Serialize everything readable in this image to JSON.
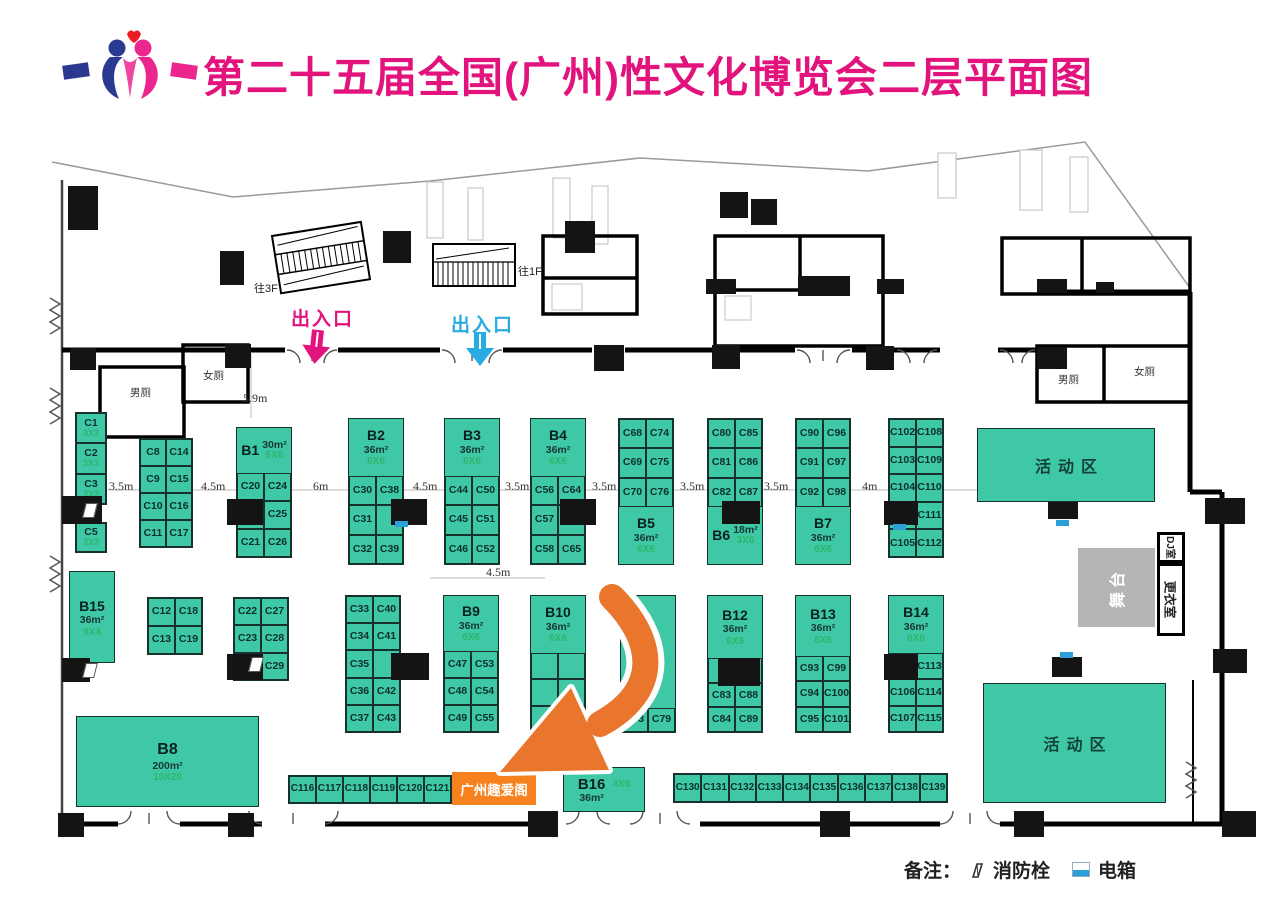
{
  "header": {
    "title": "第二十五届全国(广州)性文化博览会二层平面图",
    "logo_top": "全国(广州)性文化博览会",
    "logo_bottom": "China(Guangzhou)Sex Culture Expo"
  },
  "labels": {
    "entrance": "出入口",
    "stairs_3f": "往3F",
    "stairs_1f": "往1F",
    "toilet_male": "男厕",
    "toilet_female": "女厕",
    "stage": "舞台",
    "dj_room": "DJ室",
    "changing_room": "更衣室",
    "activity": "活动区",
    "qag": "广州趣爱阁"
  },
  "legend": {
    "note": "备注：",
    "hydrant": "消防栓",
    "power": "电箱"
  },
  "colors": {
    "booth_teal": "#3fc8a6",
    "dims_green": "#2fb56d",
    "accent_magenta": "#e2137d",
    "accent_blue": "#29abe2",
    "arrow_orange": "#e9762c",
    "qag_orange": "#f5821f",
    "stage_gray": "#b5b5b5"
  },
  "plan": {
    "dimensions": [
      {
        "t": "5.9m",
        "x": 243,
        "y": 391
      },
      {
        "t": "3.5m",
        "x": 109,
        "y": 479
      },
      {
        "t": "4.5m",
        "x": 201,
        "y": 479
      },
      {
        "t": "6m",
        "x": 313,
        "y": 479
      },
      {
        "t": "4.5m",
        "x": 413,
        "y": 479
      },
      {
        "t": "3.5m",
        "x": 505,
        "y": 479
      },
      {
        "t": "3.5m",
        "x": 592,
        "y": 479
      },
      {
        "t": "3.5m",
        "x": 680,
        "y": 479
      },
      {
        "t": "3.5m",
        "x": 764,
        "y": 479
      },
      {
        "t": "4m",
        "x": 862,
        "y": 479
      },
      {
        "t": "4.5m",
        "x": 486,
        "y": 565
      }
    ],
    "blocks": [
      {
        "name": "c1-col",
        "x": 75,
        "y": 412,
        "w": 32,
        "h": 93,
        "rows": [
          [
            "C1|3X3"
          ],
          [
            "C2|3X3"
          ],
          [
            "C3|3X3"
          ]
        ]
      },
      {
        "name": "c5",
        "x": 75,
        "y": 522,
        "w": 32,
        "h": 31,
        "rows": [
          [
            "C5|3X3"
          ]
        ]
      },
      {
        "name": "B15",
        "x": 69,
        "y": 571,
        "w": 46,
        "h": 92,
        "hdr": {
          "id": "B15",
          "area": "36m²",
          "dims": "9X4",
          "h": 92,
          "pos": "top"
        },
        "rows": []
      },
      {
        "name": "c8-blk",
        "x": 139,
        "y": 438,
        "w": 54,
        "h": 110,
        "rows": [
          [
            "C8",
            "C14"
          ],
          [
            "C9",
            "C15"
          ],
          [
            "C10",
            "C16"
          ],
          [
            "C11",
            "C17"
          ]
        ]
      },
      {
        "name": "B1",
        "x": 236,
        "y": 427,
        "w": 56,
        "h": 131,
        "hdr": {
          "id": "B1",
          "area": "30m²",
          "dims": "5X6",
          "h": 45,
          "pos": "top",
          "style": "side"
        },
        "rows": [
          [
            "C20",
            "C24"
          ],
          [
            "",
            "C25"
          ],
          [
            "C21",
            "C26"
          ]
        ]
      },
      {
        "name": "B2",
        "x": 348,
        "y": 418,
        "w": 56,
        "h": 147,
        "hdr": {
          "id": "B2",
          "area": "36m²",
          "dims": "6X6",
          "h": 57,
          "pos": "top"
        },
        "rows": [
          [
            "C30",
            "C38"
          ],
          [
            "C31",
            ""
          ],
          [
            "C32",
            "C39"
          ]
        ]
      },
      {
        "name": "B3",
        "x": 444,
        "y": 418,
        "w": 56,
        "h": 147,
        "hdr": {
          "id": "B3",
          "area": "36m²",
          "dims": "6X6",
          "h": 57,
          "pos": "top"
        },
        "rows": [
          [
            "C44",
            "C50"
          ],
          [
            "C45",
            "C51"
          ],
          [
            "C46",
            "C52"
          ]
        ]
      },
      {
        "name": "B4",
        "x": 530,
        "y": 418,
        "w": 56,
        "h": 147,
        "hdr": {
          "id": "B4",
          "area": "36m²",
          "dims": "6X6",
          "h": 57,
          "pos": "top"
        },
        "rows": [
          [
            "C56",
            "C64"
          ],
          [
            "C57",
            ""
          ],
          [
            "C58",
            "C65"
          ]
        ]
      },
      {
        "name": "B5",
        "x": 618,
        "y": 418,
        "w": 56,
        "h": 147,
        "hdr": {
          "id": "B5",
          "area": "36m²",
          "dims": "6X6",
          "h": 57,
          "pos": "bottom"
        },
        "rows": [
          [
            "C68",
            "C74"
          ],
          [
            "C69",
            "C75"
          ],
          [
            "C70",
            "C76"
          ]
        ]
      },
      {
        "name": "B6",
        "x": 707,
        "y": 418,
        "w": 56,
        "h": 147,
        "hdr": {
          "id": "B6",
          "area": "18m²",
          "dims": "3X6",
          "h": 57,
          "pos": "bottom",
          "style": "side"
        },
        "rows": [
          [
            "C80",
            "C85"
          ],
          [
            "C81",
            "C86"
          ],
          [
            "C82",
            "C87"
          ]
        ]
      },
      {
        "name": "B7",
        "x": 795,
        "y": 418,
        "w": 56,
        "h": 147,
        "hdr": {
          "id": "B7",
          "area": "36m²",
          "dims": "6X6",
          "h": 57,
          "pos": "bottom"
        },
        "rows": [
          [
            "C90",
            "C96"
          ],
          [
            "C91",
            "C97"
          ],
          [
            "C92",
            "C98"
          ]
        ]
      },
      {
        "name": "c102-blk",
        "x": 888,
        "y": 418,
        "w": 56,
        "h": 140,
        "rows": [
          [
            "C102",
            "C108"
          ],
          [
            "C103",
            "C109"
          ],
          [
            "C104",
            "C110"
          ],
          [
            "",
            "C111"
          ],
          [
            "C105",
            "C112"
          ]
        ]
      },
      {
        "name": "c12-blk",
        "x": 147,
        "y": 597,
        "w": 56,
        "h": 58,
        "rows": [
          [
            "C12",
            "C18"
          ],
          [
            "C13",
            "C19"
          ]
        ]
      },
      {
        "name": "c22-blk",
        "x": 233,
        "y": 597,
        "w": 56,
        "h": 84,
        "rows": [
          [
            "C22",
            "C27"
          ],
          [
            "C23",
            "C28"
          ],
          [
            "",
            "C29"
          ]
        ]
      },
      {
        "name": "c33-blk",
        "x": 345,
        "y": 595,
        "w": 56,
        "h": 138,
        "rows": [
          [
            "C33",
            "C40"
          ],
          [
            "C34",
            "C41"
          ],
          [
            "C35",
            ""
          ],
          [
            "C36",
            "C42"
          ],
          [
            "C37",
            "C43"
          ]
        ]
      },
      {
        "name": "B9",
        "x": 443,
        "y": 595,
        "w": 56,
        "h": 138,
        "hdr": {
          "id": "B9",
          "area": "36m²",
          "dims": "6X6",
          "h": 55,
          "pos": "top"
        },
        "rows": [
          [
            "C47",
            "C53"
          ],
          [
            "C48",
            "C54"
          ],
          [
            "C49",
            "C55"
          ]
        ]
      },
      {
        "name": "B10",
        "x": 530,
        "y": 595,
        "w": 56,
        "h": 138,
        "hdr": {
          "id": "B10",
          "area": "36m²",
          "dims": "6X6",
          "h": 57,
          "pos": "top"
        },
        "rows": [
          [
            "",
            ""
          ],
          [
            "",
            ""
          ],
          [
            "",
            ""
          ]
        ]
      },
      {
        "name": "B11",
        "x": 620,
        "y": 595,
        "w": 56,
        "h": 138,
        "hdr": {
          "id": "B11",
          "area": "72m²",
          "dims": "12X6",
          "h": 112,
          "pos": "top"
        },
        "rows": [
          [
            "C73",
            "C79"
          ]
        ]
      },
      {
        "name": "B12",
        "x": 707,
        "y": 595,
        "w": 56,
        "h": 138,
        "hdr": {
          "id": "B12",
          "area": "36m²",
          "dims": "6X6",
          "h": 62,
          "pos": "top"
        },
        "rows": [
          [
            "",
            ""
          ],
          [
            "C83",
            "C88"
          ],
          [
            "C84",
            "C89"
          ]
        ]
      },
      {
        "name": "B13",
        "x": 795,
        "y": 595,
        "w": 56,
        "h": 138,
        "hdr": {
          "id": "B13",
          "area": "36m²",
          "dims": "6X6",
          "h": 60,
          "pos": "top"
        },
        "rows": [
          [
            "C93",
            "C99"
          ],
          [
            "C94",
            "C100"
          ],
          [
            "C95",
            "C101"
          ]
        ]
      },
      {
        "name": "B14",
        "x": 888,
        "y": 595,
        "w": 56,
        "h": 138,
        "hdr": {
          "id": "B14",
          "area": "36m²",
          "dims": "6X6",
          "h": 57,
          "pos": "top"
        },
        "rows": [
          [
            "",
            "C113"
          ],
          [
            "C106",
            "C114"
          ],
          [
            "C107",
            "C115"
          ]
        ]
      },
      {
        "name": "B8",
        "x": 76,
        "y": 716,
        "w": 183,
        "h": 91,
        "hdr": {
          "id": "B8",
          "area": "200m²",
          "dims": "10X20",
          "h": 91,
          "pos": "top",
          "big": true
        },
        "rows": []
      },
      {
        "name": "B16",
        "x": 563,
        "y": 767,
        "w": 82,
        "h": 45,
        "hdr": {
          "id": "B16",
          "area": "36m²",
          "dims": "4X9",
          "h": 45,
          "pos": "top",
          "style": "b16"
        },
        "rows": []
      }
    ],
    "strips": [
      {
        "cells": [
          "C116",
          "C117",
          "C118",
          "C119",
          "C120",
          "C121"
        ],
        "x": 288,
        "y": 775,
        "cw": 27.3,
        "h": 29
      },
      {
        "cells": [
          "C130",
          "C131",
          "C132",
          "C133",
          "C134",
          "C135",
          "C136",
          "C137",
          "C138",
          "C139"
        ],
        "x": 673,
        "y": 773,
        "cw": 27.5,
        "h": 30
      }
    ],
    "qag_box": {
      "x": 452,
      "y": 772,
      "w": 84,
      "h": 33
    },
    "areas": [
      {
        "x": 977,
        "y": 428,
        "w": 178,
        "h": 74
      },
      {
        "x": 983,
        "y": 683,
        "w": 183,
        "h": 120
      }
    ],
    "stage_box": {
      "x": 1078,
      "y": 548,
      "w": 77,
      "h": 79
    },
    "dj_box": {
      "x": 1157,
      "y": 532,
      "w": 28,
      "h": 31
    },
    "changing_box": {
      "x": 1157,
      "y": 563,
      "w": 28,
      "h": 73
    },
    "pillars": [
      [
        68,
        186,
        30,
        44
      ],
      [
        220,
        251,
        24,
        34
      ],
      [
        383,
        231,
        28,
        32
      ],
      [
        565,
        221,
        30,
        32
      ],
      [
        720,
        192,
        28,
        26
      ],
      [
        751,
        199,
        26,
        26
      ],
      [
        877,
        279,
        27,
        15
      ],
      [
        1037,
        279,
        30,
        14
      ],
      [
        706,
        279,
        30,
        15
      ],
      [
        798,
        276,
        52,
        20
      ],
      [
        1096,
        282,
        18,
        11
      ],
      [
        70,
        348,
        26,
        22
      ],
      [
        225,
        344,
        26,
        24
      ],
      [
        594,
        345,
        30,
        26
      ],
      [
        712,
        345,
        28,
        24
      ],
      [
        866,
        346,
        28,
        24
      ],
      [
        1037,
        347,
        30,
        22
      ],
      [
        62,
        496,
        40,
        28
      ],
      [
        227,
        499,
        36,
        26
      ],
      [
        391,
        499,
        36,
        26
      ],
      [
        560,
        499,
        36,
        26
      ],
      [
        722,
        501,
        38,
        23
      ],
      [
        884,
        501,
        34,
        24
      ],
      [
        1048,
        500,
        30,
        19
      ],
      [
        227,
        654,
        36,
        26
      ],
      [
        391,
        653,
        38,
        27
      ],
      [
        718,
        658,
        42,
        28
      ],
      [
        884,
        654,
        34,
        26
      ],
      [
        1052,
        657,
        30,
        20
      ],
      [
        62,
        658,
        28,
        24
      ],
      [
        58,
        813,
        26,
        24
      ],
      [
        228,
        813,
        26,
        24
      ],
      [
        528,
        811,
        30,
        26
      ],
      [
        820,
        811,
        30,
        26
      ],
      [
        1014,
        811,
        30,
        26
      ],
      [
        1222,
        811,
        34,
        26
      ],
      [
        1205,
        498,
        40,
        26
      ],
      [
        1213,
        649,
        34,
        24
      ]
    ],
    "power_marks": [
      [
        893,
        524
      ],
      [
        1056,
        520
      ],
      [
        1060,
        652
      ],
      [
        395,
        521
      ]
    ],
    "hydrant_marks": [
      [
        84,
        503
      ],
      [
        84,
        663
      ],
      [
        250,
        657
      ]
    ]
  }
}
